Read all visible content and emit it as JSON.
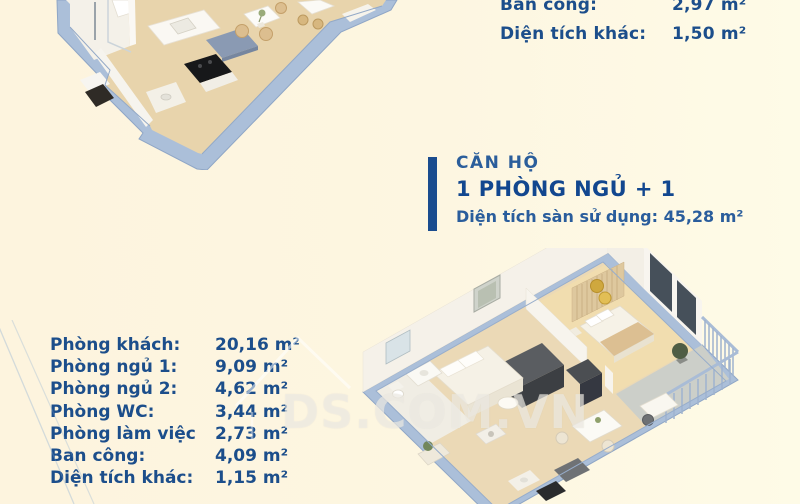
{
  "page": {
    "background_color": "#FDF6E1",
    "text_color": "#1C4E8B",
    "accent_color": "#1A4C8E",
    "watermark_text": "DS.COM.VN"
  },
  "summary_top": {
    "rows": [
      {
        "label": "Ban công:",
        "value": "2,97 m²"
      },
      {
        "label": "Diện tích khác:",
        "value": "1,50 m²"
      }
    ]
  },
  "heading": {
    "kicker": "CĂN HỘ",
    "title": "1 PHÒNG NGỦ + 1",
    "subtitle": "Diện tích sàn sử dụng: 45,28 m²"
  },
  "room_table": {
    "rows": [
      {
        "label": "Phòng khách:",
        "value": "20,16 m²"
      },
      {
        "label": "Phòng ngủ 1:",
        "value": "9,09 m²"
      },
      {
        "label": "Phòng ngủ 2:",
        "value": "4,62 m²"
      },
      {
        "label": "Phòng WC:",
        "value": "3,44 m²"
      },
      {
        "label": "Phòng làm việc",
        "value": "2,73 m²"
      },
      {
        "label": "Ban công:",
        "value": "4,09 m²"
      },
      {
        "label": "Diện tích khác:",
        "value": "1,15 m²"
      }
    ]
  },
  "floorplans": {
    "top_partial": "3d-floorplan-partial-kitchen-bath",
    "main": "3d-floorplan-one-bedroom-apartment"
  }
}
